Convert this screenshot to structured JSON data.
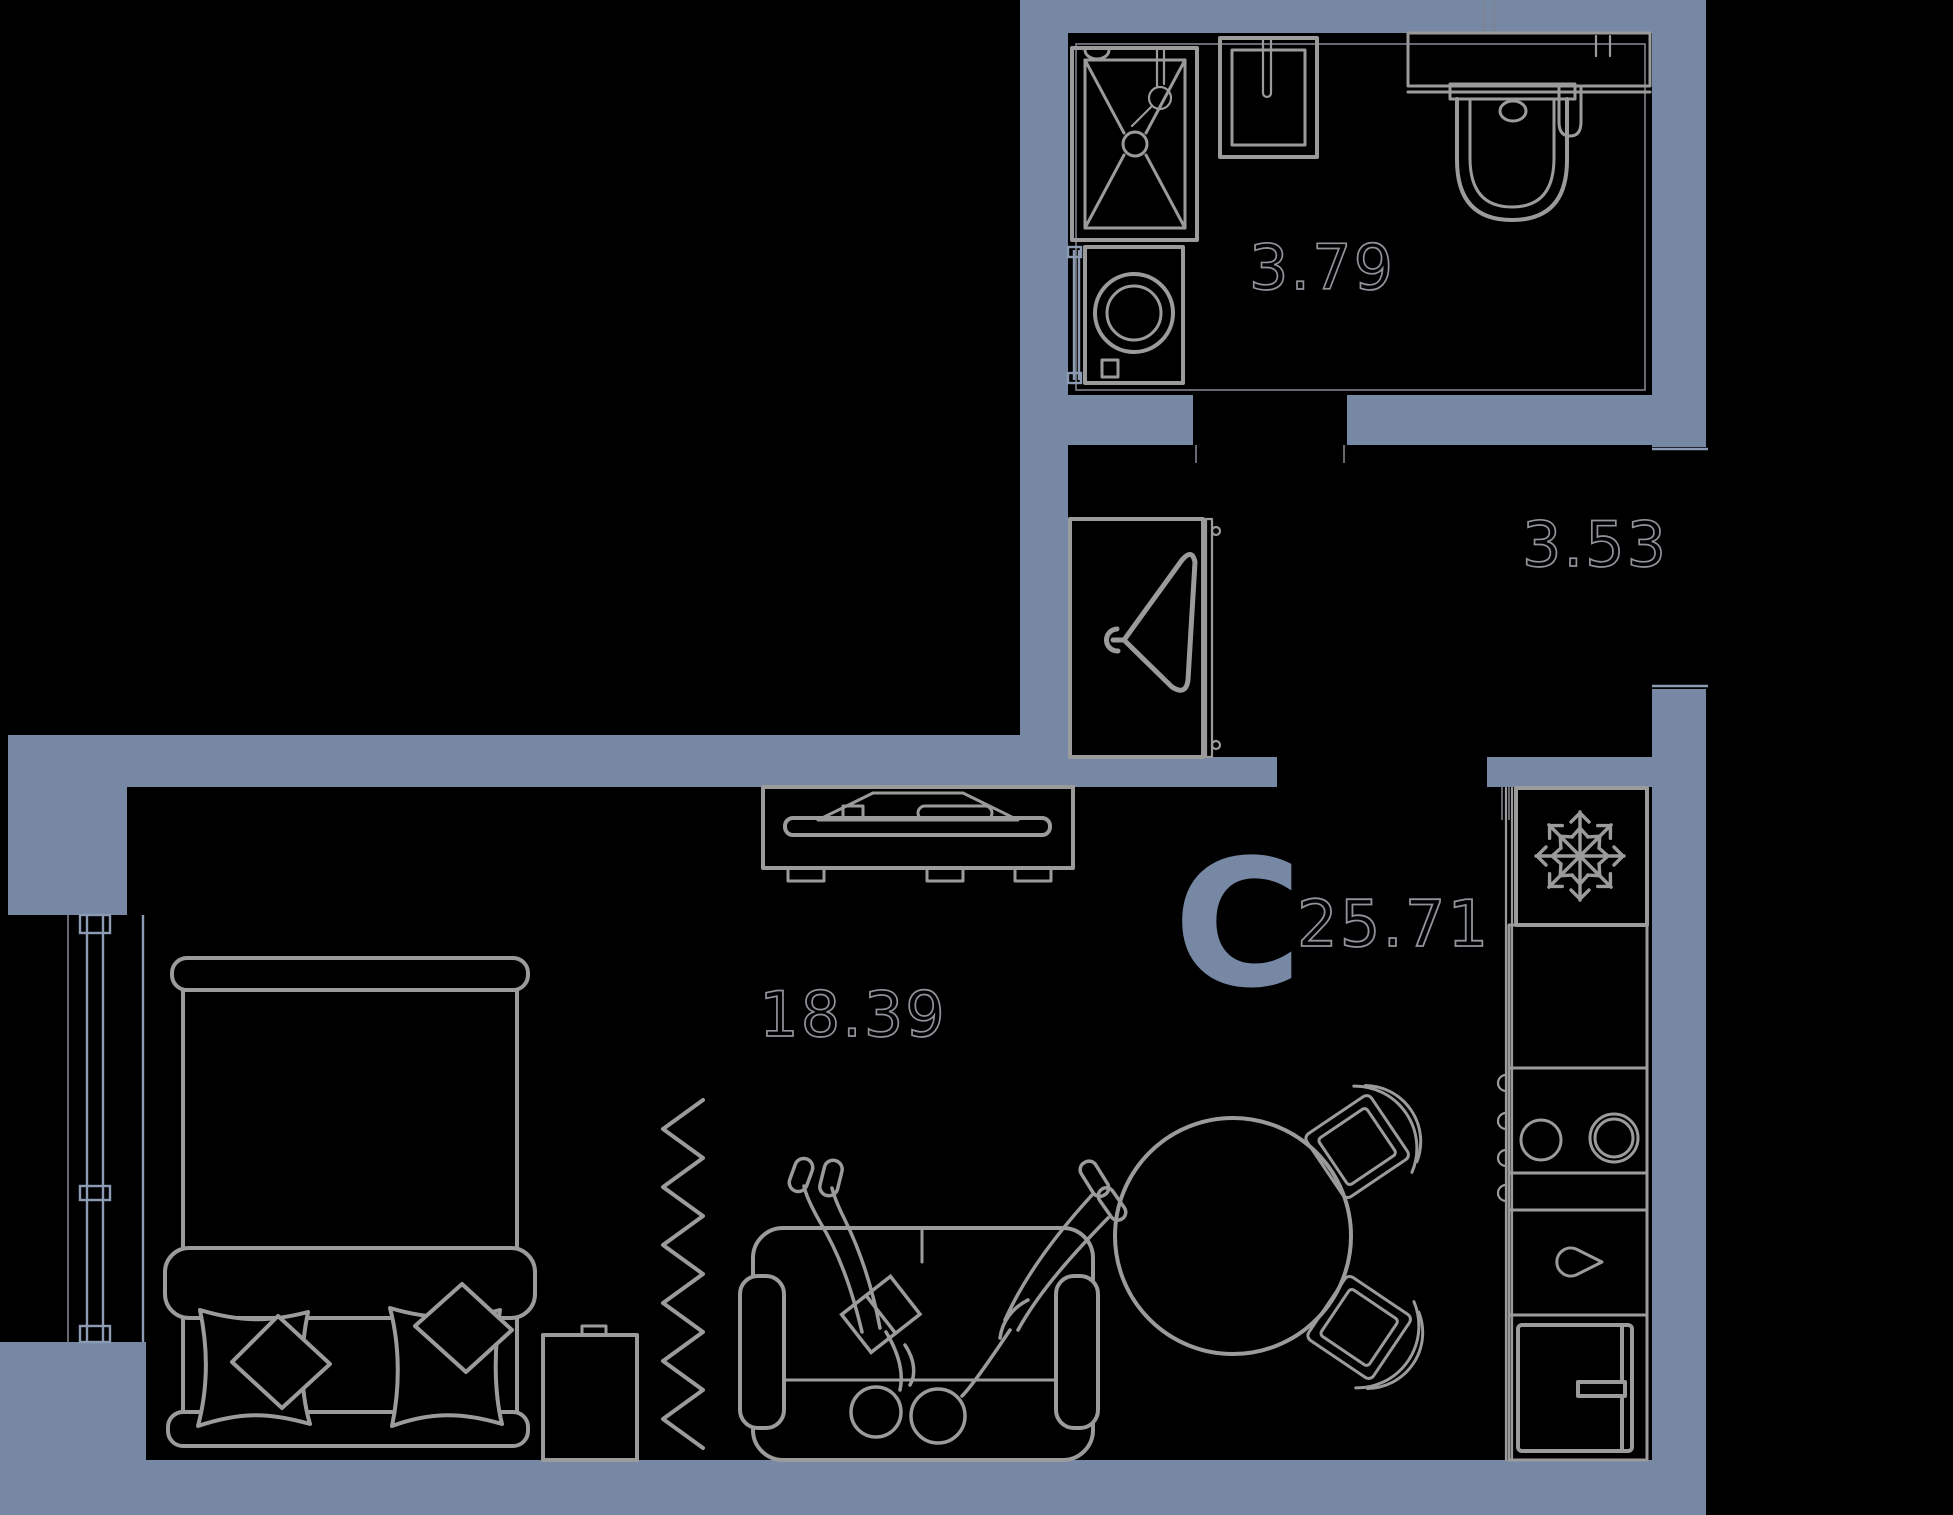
{
  "plan": {
    "unit_type_letter": "C",
    "total_area": "25.71",
    "rooms": [
      {
        "name": "bathroom",
        "area": "3.79"
      },
      {
        "name": "hallway",
        "area": "3.53"
      },
      {
        "name": "living-room",
        "area": "18.39"
      }
    ]
  },
  "colors": {
    "bg": "#000000",
    "wall": "#7688A3",
    "line": "#9B9B9B",
    "thin": "#8C9BB3",
    "label": "#909399"
  }
}
